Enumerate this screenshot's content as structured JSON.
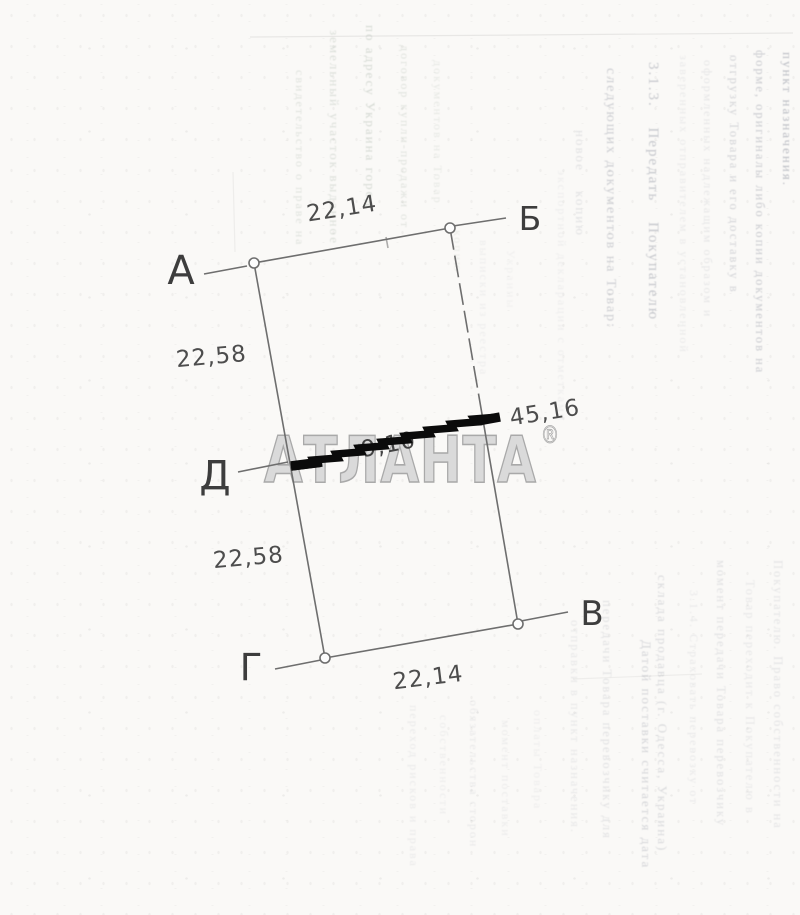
{
  "plot": {
    "labels": {
      "a": "А",
      "b": "Б",
      "v": "В",
      "g": "Г",
      "d": "Д"
    },
    "dims": {
      "top": "22,14",
      "left_upper": "22,58",
      "left_lower": "22,58",
      "bottom": "22,14",
      "cross": "45,16",
      "redacted": "9,10"
    }
  },
  "watermark": {
    "text": "АТЛАНТА",
    "reg": "®"
  },
  "bleed": {
    "right_top": [
      "пункт назначения.",
      "форме, оригиналы либо копии документов на",
      "отгрузку Товара и его доставку в",
      "оформленных надлежащим образом и",
      "заверенных отправителем в установленной",
      "3.1.3. Передать Покупателю",
      "следующих документов на Товар:",
      "новое копию",
      "экспортной декларации с отметками"
    ],
    "right_bottom": [
      "Покупателю. Право собственности на",
      "Товар переходит к Покупателю в",
      "момент передачи Товара перевозчику",
      "3.1.4. Страховать перевозку от",
      "склада продавца (г. Одесса, Украина)",
      "Датой поставки считается дата",
      "передачи Товара перевозчику для",
      "отправки в пункт назначения."
    ],
    "bottom_mid": [
      "переход рисков и права",
      "собственности",
      "обязательства сторон",
      "момент поставки",
      "оплаты Товара"
    ],
    "inner": [
      "свидетельство о праве на",
      "земельный участок выданное",
      "по адресу Украина город",
      "договор купли-продажи от",
      "документов на Товар",
      "копию",
      "выписки из реестра",
      "Украины"
    ]
  },
  "colors": {
    "paper": "#faf9f7",
    "line": "#6e6e6e",
    "label": "#3d3d3d",
    "dim": "#4d4d4d",
    "wmfill": "#dadada",
    "wmstroke": "#a9a9a9",
    "redact": "#0b0b0b",
    "ink": "#7d8291",
    "green": "#7f9180"
  }
}
